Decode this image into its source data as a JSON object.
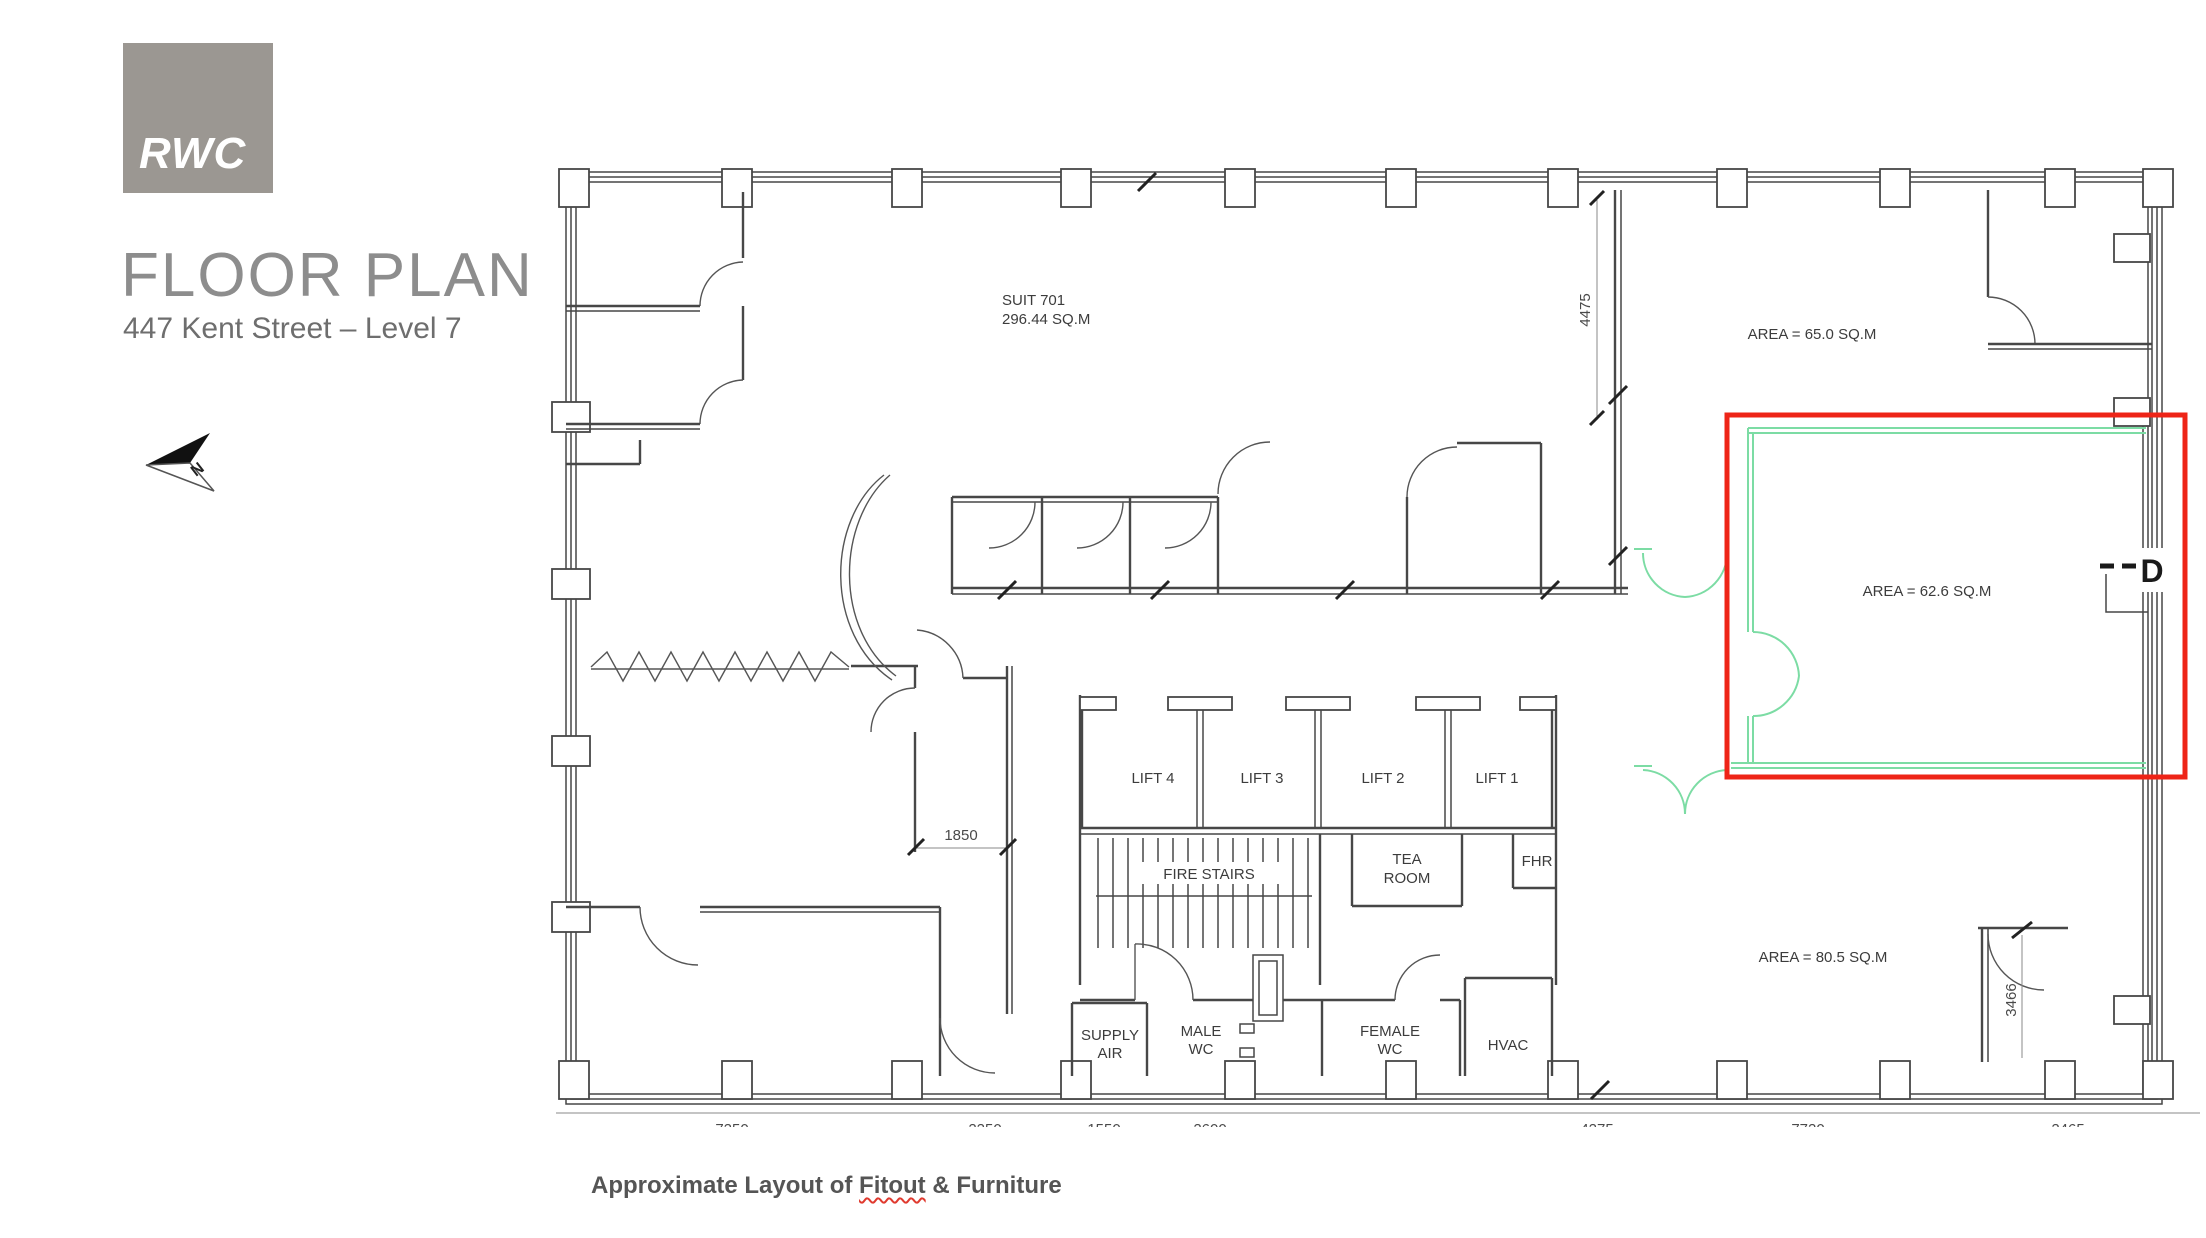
{
  "branding": {
    "logo_text": "RWC"
  },
  "header": {
    "title": "FLOOR PLAN",
    "subtitle": "447 Kent Street – Level 7"
  },
  "caption": {
    "prefix": "Approximate Layout of ",
    "underlined_word": "Fitout",
    "suffix": " & Furniture"
  },
  "colors": {
    "logo_gray": "#9b9792",
    "title_gray": "#8d8d8d",
    "caption_gray": "#555555",
    "highlight_red": "#ee2417",
    "plan_green": "#7cdca4",
    "plan_line": "#474747"
  },
  "plan": {
    "suite": {
      "name": "SUIT 701",
      "area": "296.44 SQ.M"
    },
    "area_labels": {
      "top_right": "AREA = 65.0 SQ.M",
      "highlighted": "AREA = 62.6 SQ.M",
      "bottom_right": "AREA = 80.5 SQ.M"
    },
    "core": {
      "lifts": [
        "LIFT 4",
        "LIFT 3",
        "LIFT 2",
        "LIFT 1"
      ],
      "fire_stairs": "FIRE STAIRS",
      "tea_room": [
        "TEA",
        "ROOM"
      ],
      "fhr": "FHR",
      "supply_air": [
        "SUPPLY",
        "AIR"
      ],
      "male_wc": [
        "MALE",
        "WC"
      ],
      "female_wc": [
        "FEMALE",
        "WC"
      ],
      "hvac": "HVAC"
    },
    "door_label": "D",
    "dimensions": {
      "suite_depth": "4475",
      "corridor_width": "1850",
      "bottom_right_depth": "3466",
      "bottom_row": [
        "7250",
        "2250",
        "1550",
        "2600",
        "4275",
        "7720",
        "2465"
      ]
    },
    "north_label": "N"
  }
}
